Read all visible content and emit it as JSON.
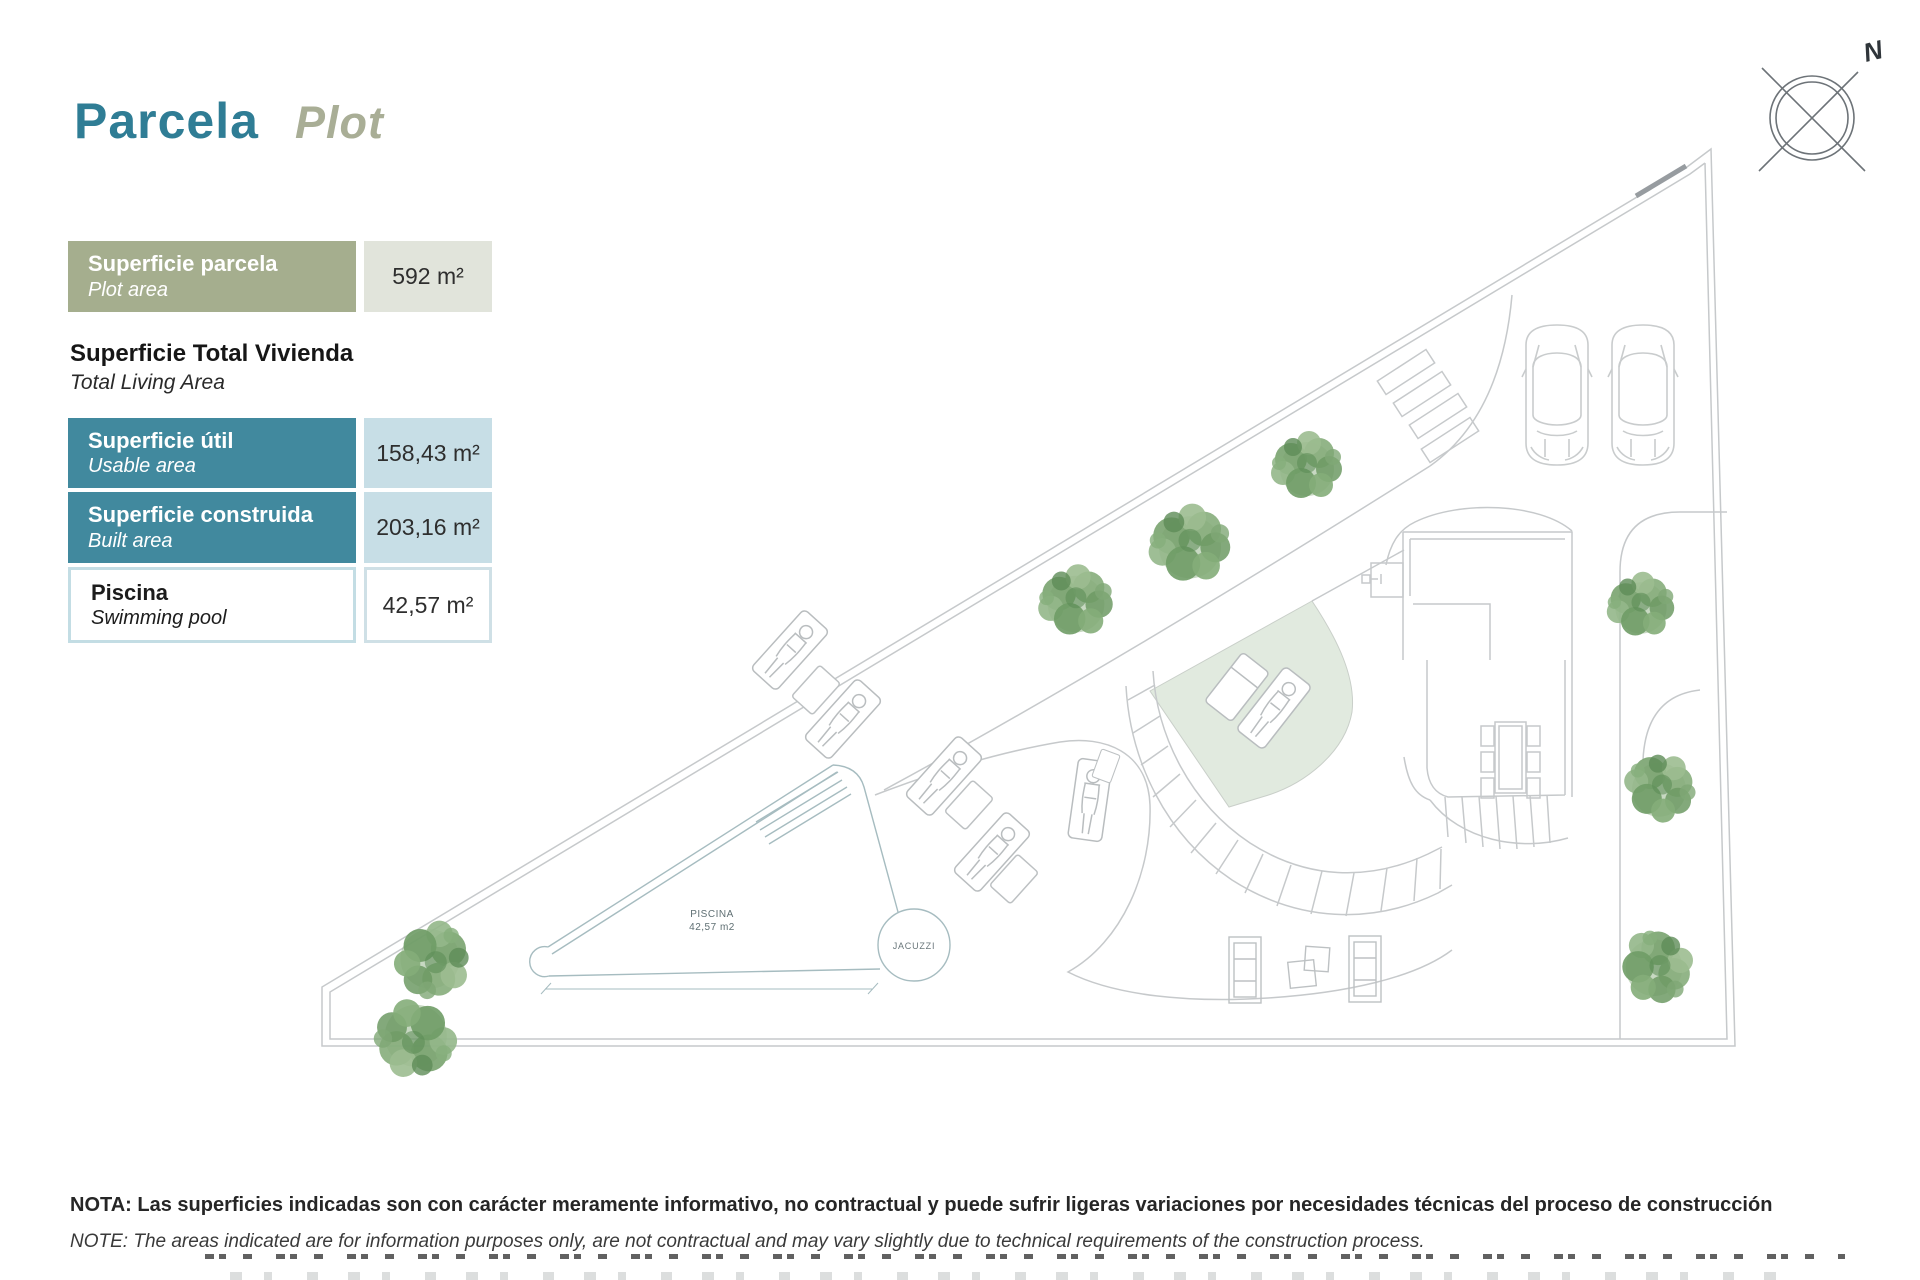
{
  "title": {
    "es": "Parcela",
    "en": "Plot"
  },
  "compass": {
    "north_label": "N"
  },
  "area_table": {
    "section_heading": {
      "es": "Superficie Total Vivienda",
      "en": "Total Living Area"
    },
    "rows": [
      {
        "label_es": "Superficie parcela",
        "label_en": "Plot area",
        "value": "592 m²"
      },
      {
        "label_es": "Superficie útil",
        "label_en": "Usable area",
        "value": "158,43 m²"
      },
      {
        "label_es": "Superficie construida",
        "label_en": "Built area",
        "value": "203,16 m²"
      },
      {
        "label_es": "Piscina",
        "label_en": "Swimming pool",
        "value": "42,57 m²"
      }
    ]
  },
  "plan": {
    "pool_label_line1": "PISCINA",
    "pool_label_line2": "42,57 m2",
    "jacuzzi_label": "JACUZZI"
  },
  "note": {
    "es": "NOTA: Las superficies indicadas son con carácter meramente informativo, no contractual y puede sufrir ligeras variaciones por necesidades técnicas del proceso de construcción",
    "en": "NOTE: The areas indicated are for information purposes only, are not contractual and may vary slightly due to technical requirements of the construction process."
  },
  "colors": {
    "title_teal": "#2f7d95",
    "title_sage": "#a9ae96",
    "row_sage_green": "#a5ae8e",
    "row_teal": "#41899e",
    "value_light_green": "#e1e4db",
    "value_light_blue": "#c7dee6",
    "pool_border_blue": "#c3dde4",
    "plan_line_gray": "#c6c9cb",
    "pool_line_teal": "#a6bcc0",
    "lawn_green": "#e1eadf",
    "tree_green": "#7ba371"
  }
}
